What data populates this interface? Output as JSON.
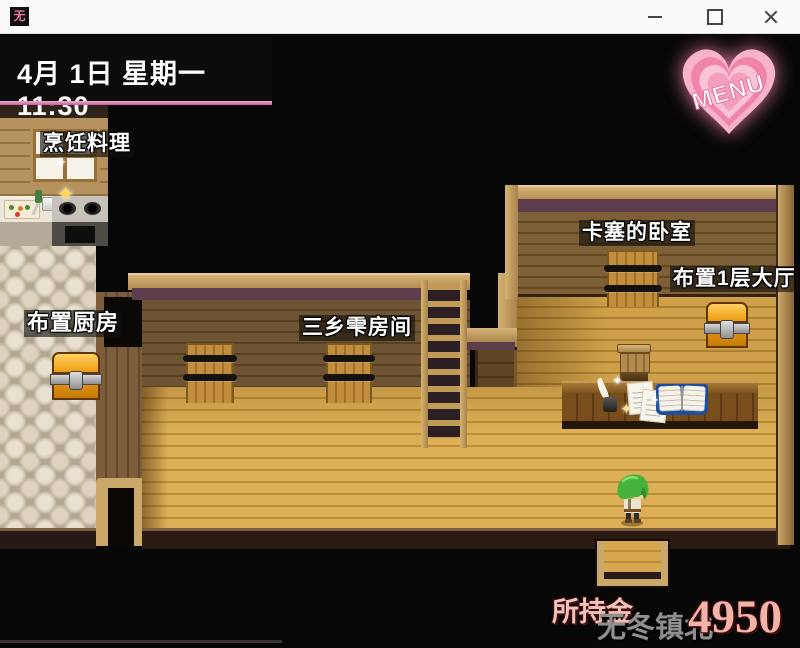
{
  "window": {
    "icon_glyph": "无"
  },
  "hud": {
    "datetime": "4月 1日 星期一 11:30",
    "menu": "MENU"
  },
  "labels": {
    "cooking": "烹饪料理",
    "arrange_kitchen": "布置厨房",
    "misato_room": "三乡雫房间",
    "kase_bedroom": "卡塞的卧室",
    "arrange_hall": "布置1层大厅"
  },
  "status": {
    "money_label": "所持金",
    "location": "无冬镇北",
    "money": "4950"
  },
  "decor": {
    "sparkle": "✦"
  },
  "colors": {
    "accent_pink_line": "#e287b9",
    "heart_pink": "#f287b1",
    "money_text": "#f4b3a9",
    "location_text": "#8f8f8f",
    "floor_gold": "#d9a94f",
    "wall_dark_wood": "#6e5434",
    "cobblestone": "#ddd3c0",
    "chest_orange": "#f0a01c",
    "label_background": "rgba(18,14,12,0.62)"
  }
}
